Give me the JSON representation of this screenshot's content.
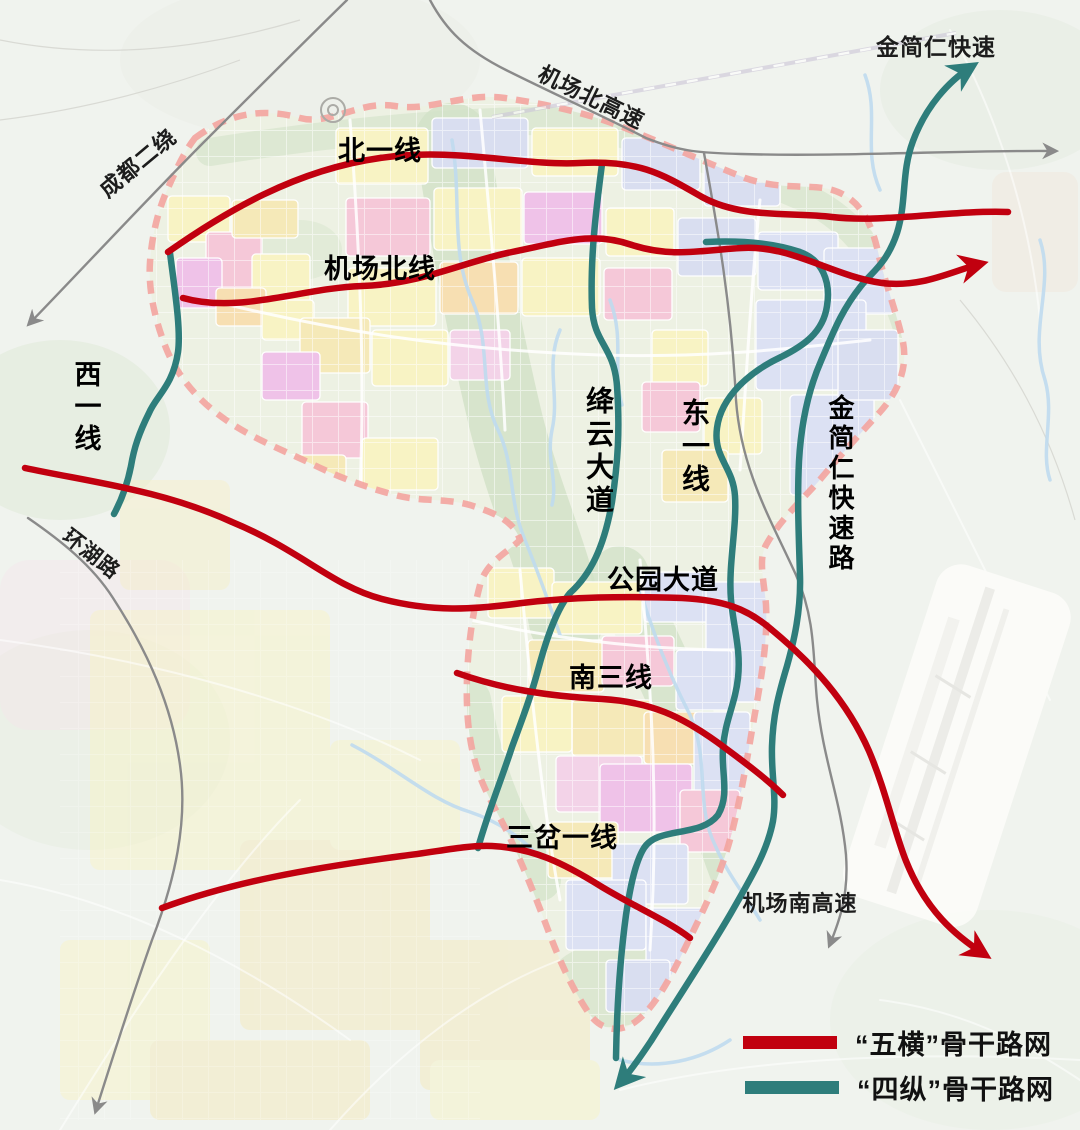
{
  "title": "“五横四纵”骨干路网规划示意图",
  "colors": {
    "horizontal_red": "#C1000F",
    "vertical_teal": "#2E7D7B",
    "context_gray": "#8A8A8A",
    "boundary_pink": "#F3A49E"
  },
  "roads": {
    "horizontal": [
      {
        "id": "bei-yi-xian",
        "label": "北一线"
      },
      {
        "id": "jichang-bei-xian",
        "label": "机场北线"
      },
      {
        "id": "gongyuan-dadao",
        "label": "公园大道"
      },
      {
        "id": "nan-san-xian",
        "label": "南三线"
      },
      {
        "id": "san-cha-yi-xian",
        "label": "三岔一线"
      }
    ],
    "vertical": [
      {
        "id": "xi-yi-xian",
        "label": "西一线"
      },
      {
        "id": "jiangyun-dadao",
        "label": "绛云大道"
      },
      {
        "id": "dong-yi-xian",
        "label": "东一线"
      },
      {
        "id": "jinjianren-kuaisulu",
        "label": "金简仁快速路"
      }
    ],
    "context": [
      {
        "id": "chengdu-er-rao",
        "label": "成都二绕"
      },
      {
        "id": "jichang-bei-gaosu",
        "label": "机场北高速"
      },
      {
        "id": "jinjianren-kuaisu",
        "label": "金简仁快速"
      },
      {
        "id": "huanhu-lu",
        "label": "环湖路"
      },
      {
        "id": "jichang-nan-gaosu",
        "label": "机场南高速"
      }
    ]
  },
  "legend": {
    "items": [
      {
        "label": "“五横”骨干路网",
        "color_key": "horizontal_red"
      },
      {
        "label": "“四纵”骨干路网",
        "color_key": "vertical_teal"
      }
    ]
  }
}
